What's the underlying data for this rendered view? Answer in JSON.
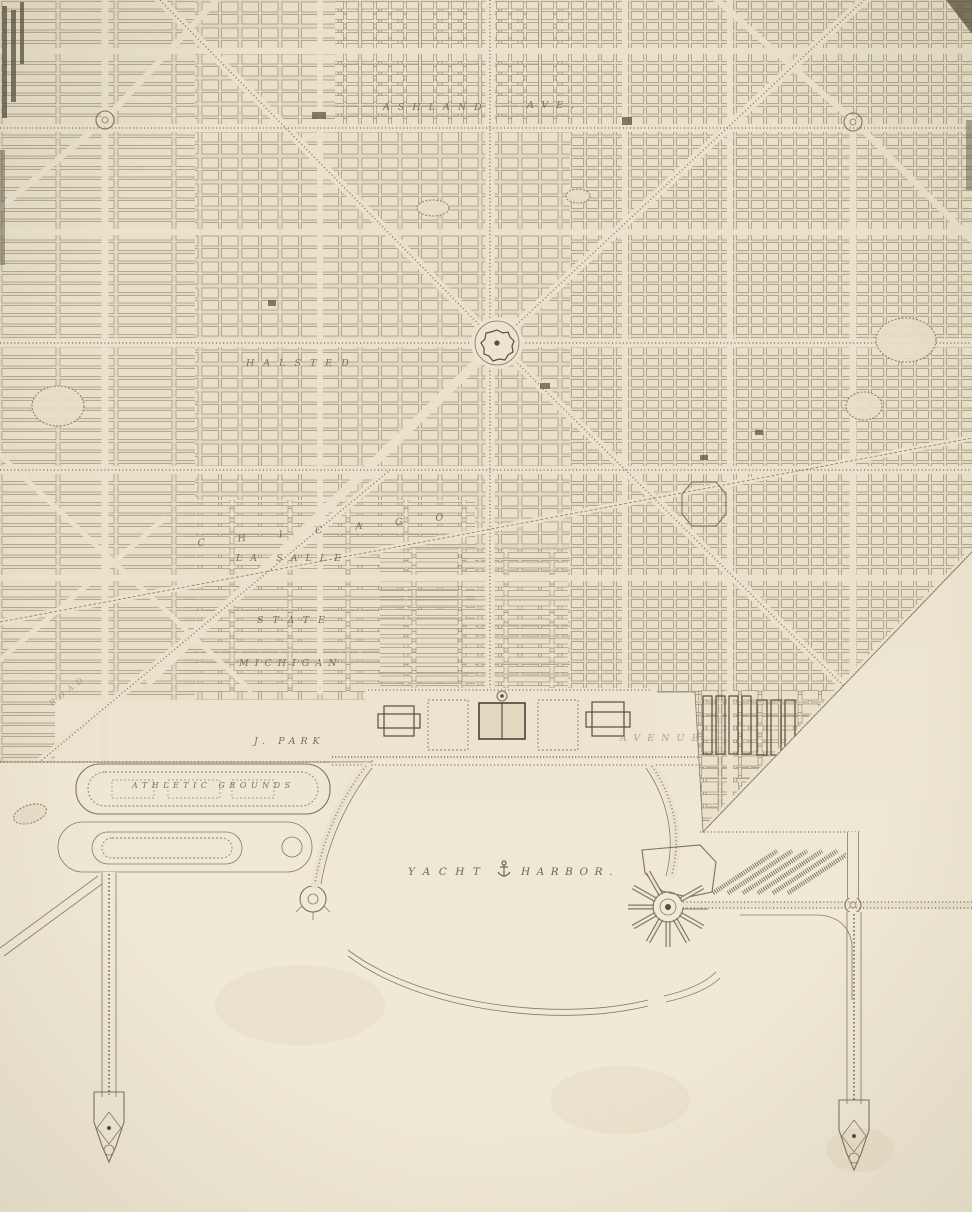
{
  "artwork": {
    "kind": "engraved-city-plan-plate",
    "scene": "gridded city with radiating diagonal boulevards above a lakefront yacht harbor flanked by two long ornamental piers"
  },
  "labels": {
    "ashland": "ASHLAND",
    "ashland_ave": "AVE.",
    "halsted": "HALSTED",
    "chicago": "CHICAGO",
    "la_salle": "LA SALLE",
    "state": "STATE",
    "michigan": "MICHIGAN",
    "j_park": "J. PARK",
    "avenue": "AVENUE",
    "athletic_grounds": "ATHLETIC  GROUNDS",
    "yacht": "YACHT",
    "harbor": "HARBOR.",
    "road": "ROAD"
  },
  "features": [
    "city street grid",
    "diagonal boulevards",
    "civic center plaza",
    "traffic circles",
    "formal lakefront gardens with museum buildings",
    "athletic grounds oval",
    "park lagoon",
    "yacht harbor basin",
    "breakwater arc",
    "fan-shaped recreation pier",
    "boat slips",
    "west municipal pier",
    "east municipal pier",
    "tree-lined causeway"
  ],
  "colors": {
    "paper_top": "#e5dcc6",
    "paper_mid": "#ece4d0",
    "paper_bottom": "#f1ebd9",
    "block_fill": "#e9e1ca",
    "ink": "#7d7460",
    "ink_faint": "#968b72",
    "ink_dark": "#4c4637",
    "label_ink": "#7b7159"
  }
}
